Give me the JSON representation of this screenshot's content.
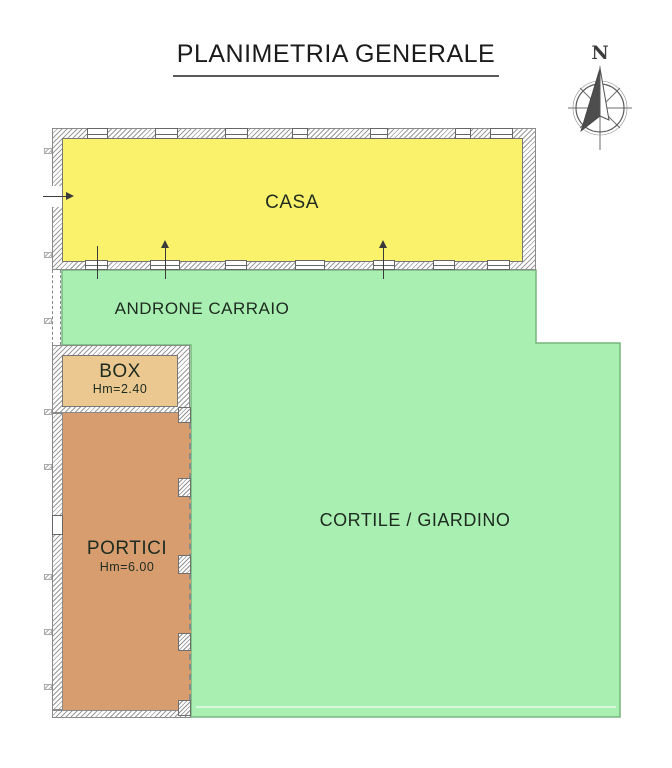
{
  "title": "PLANIMETRIA GENERALE",
  "compass": {
    "north_label": "N"
  },
  "rooms": {
    "casa": {
      "label": "CASA",
      "fill": "#FBF26B"
    },
    "androne": {
      "label": "ANDRONE CARRAIO"
    },
    "box": {
      "label": "BOX",
      "height_note": "Hm=2.40",
      "fill": "#EBC88F"
    },
    "portici": {
      "label": "PORTICI",
      "height_note": "Hm=6.00",
      "fill": "#D79D6E"
    },
    "cortile": {
      "label": "CORTILE / GIARDINO",
      "fill": "#A9EFB2"
    }
  },
  "colors": {
    "wall_hatch": "#9A9A9A",
    "wall_outline": "#777777",
    "courtyard_border": "#76B77C",
    "text": "#1C1C1C"
  }
}
